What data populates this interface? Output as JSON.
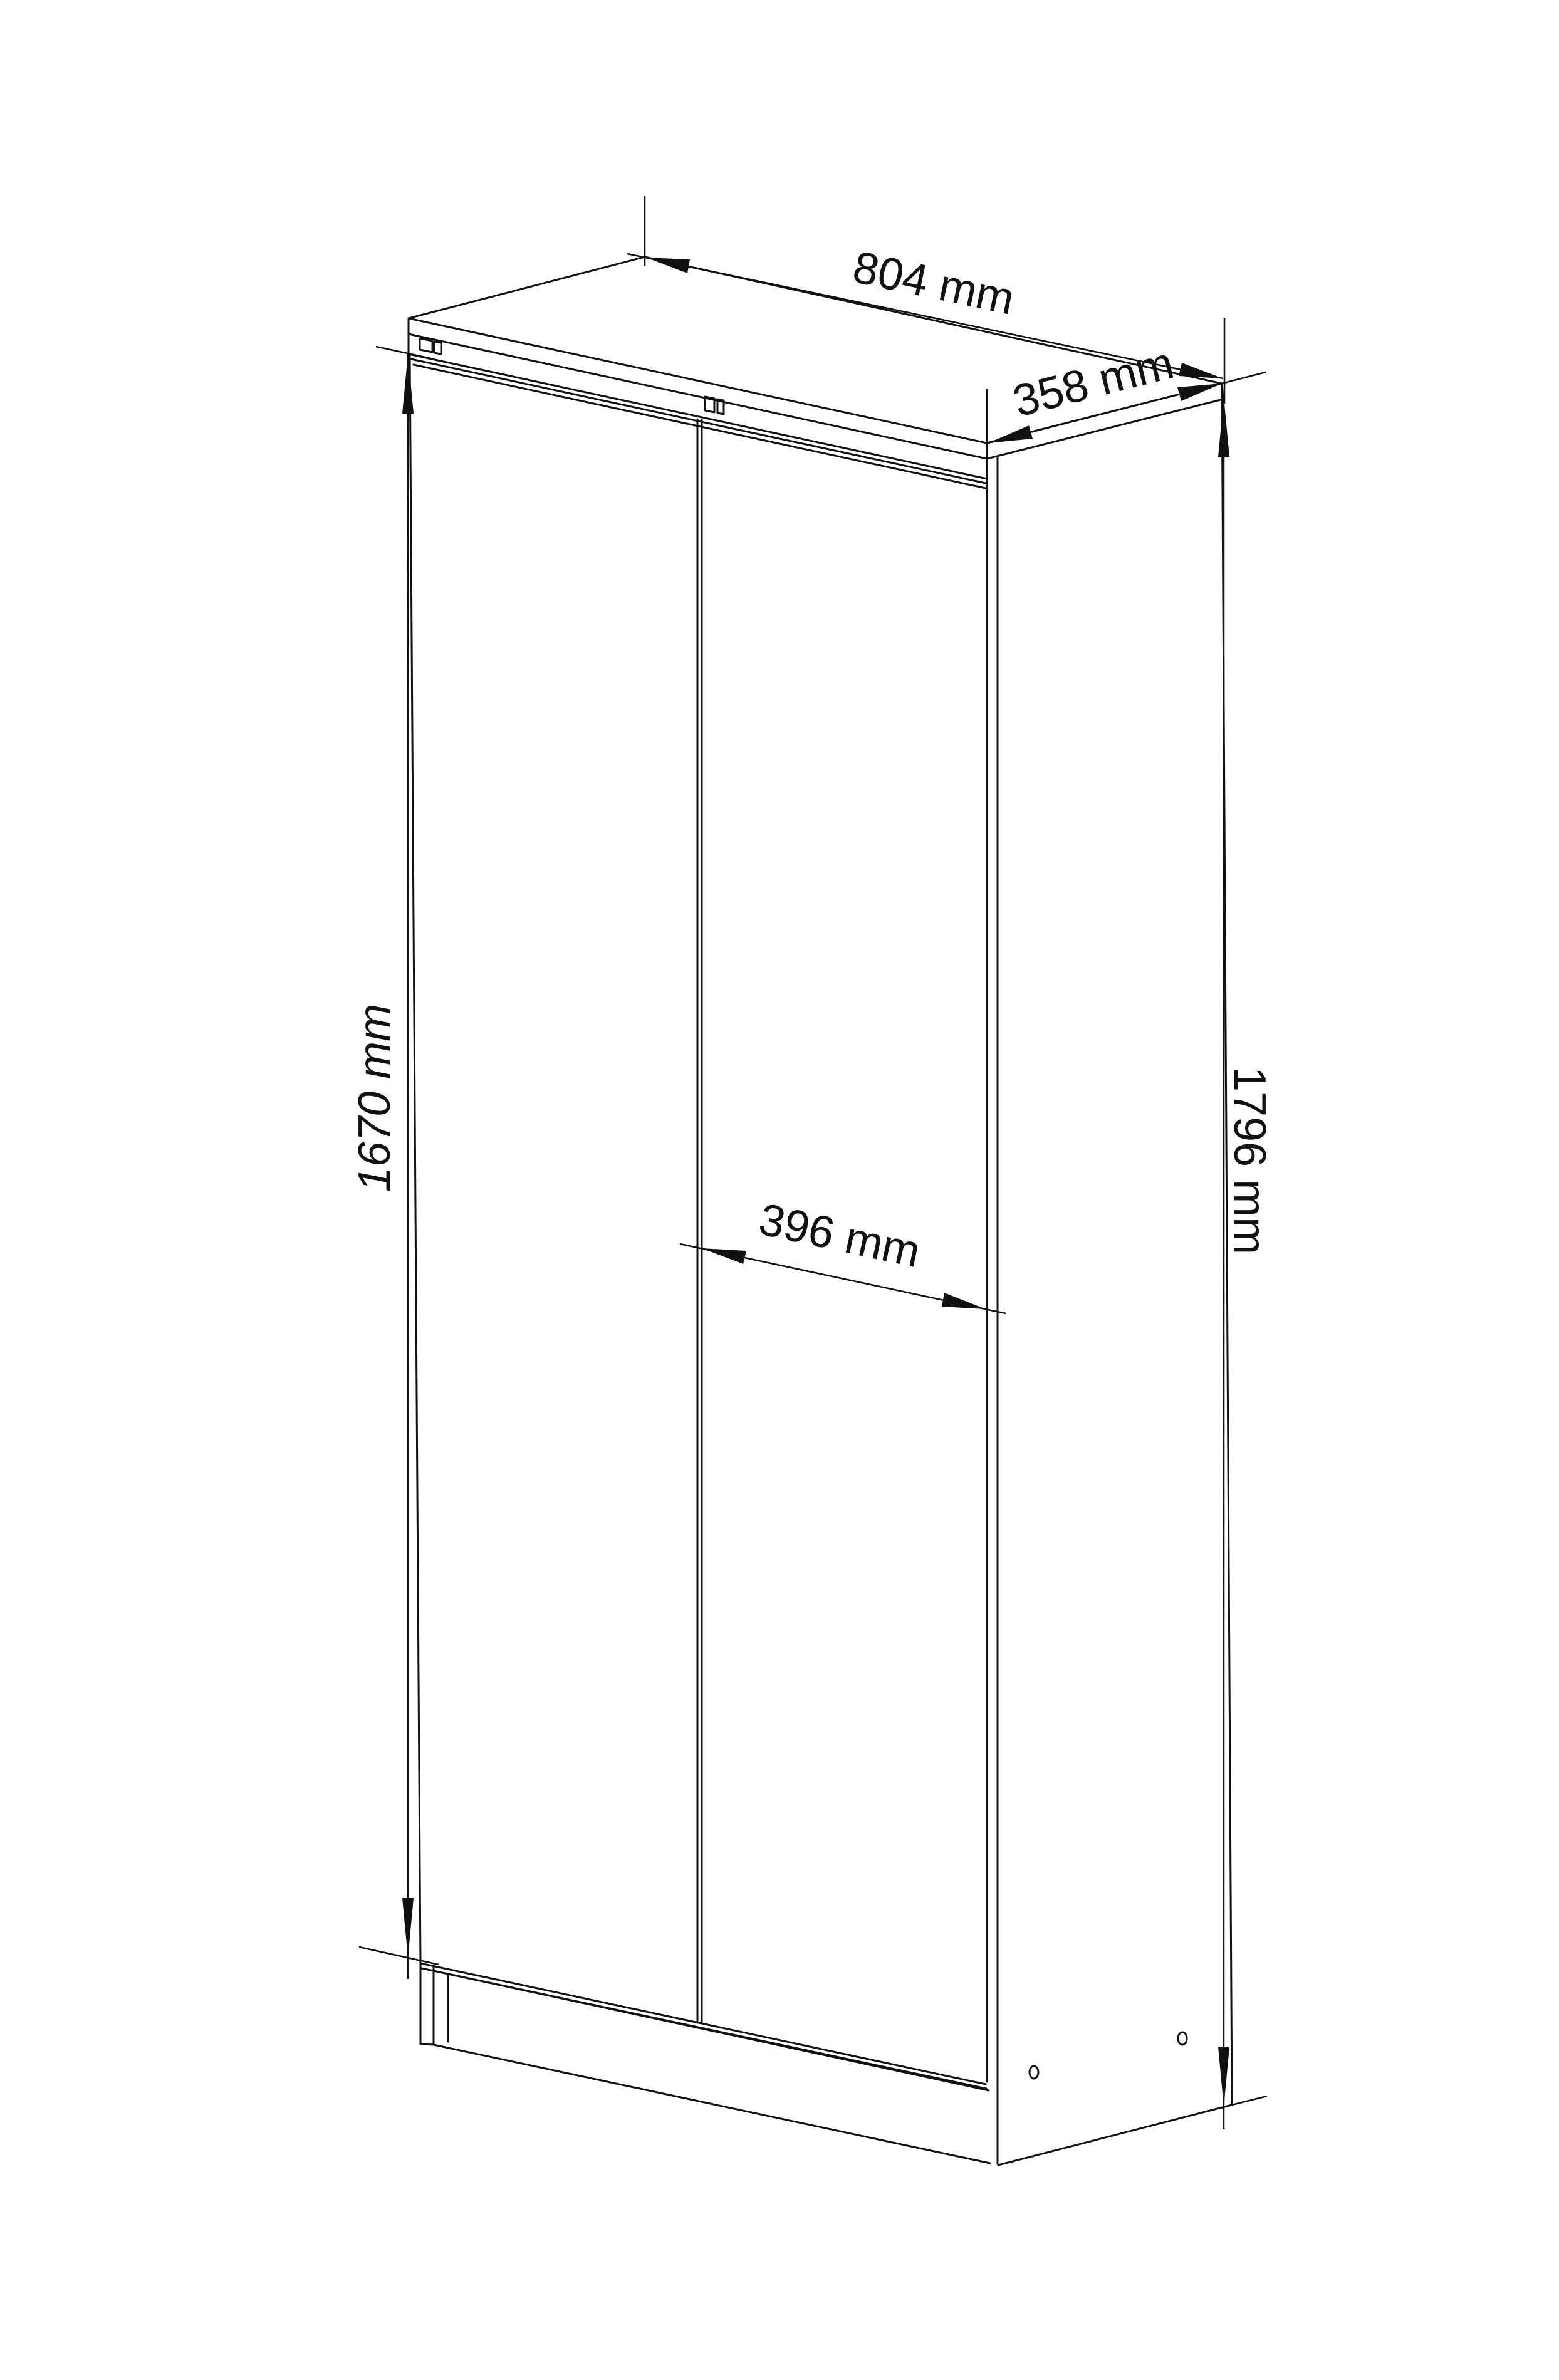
{
  "drawing": {
    "unit": "mm",
    "background_color": "#ffffff",
    "line_color": "#111111",
    "dimensions": {
      "width_top": {
        "label": "804 mm",
        "value": 804
      },
      "depth_top": {
        "label": "358 mm",
        "value": 358
      },
      "door_width": {
        "label": "396 mm",
        "value": 396
      },
      "door_height": {
        "label": "1670 mm",
        "value": 1670
      },
      "total_height": {
        "label": "1796 mm",
        "value": 1796
      }
    }
  }
}
